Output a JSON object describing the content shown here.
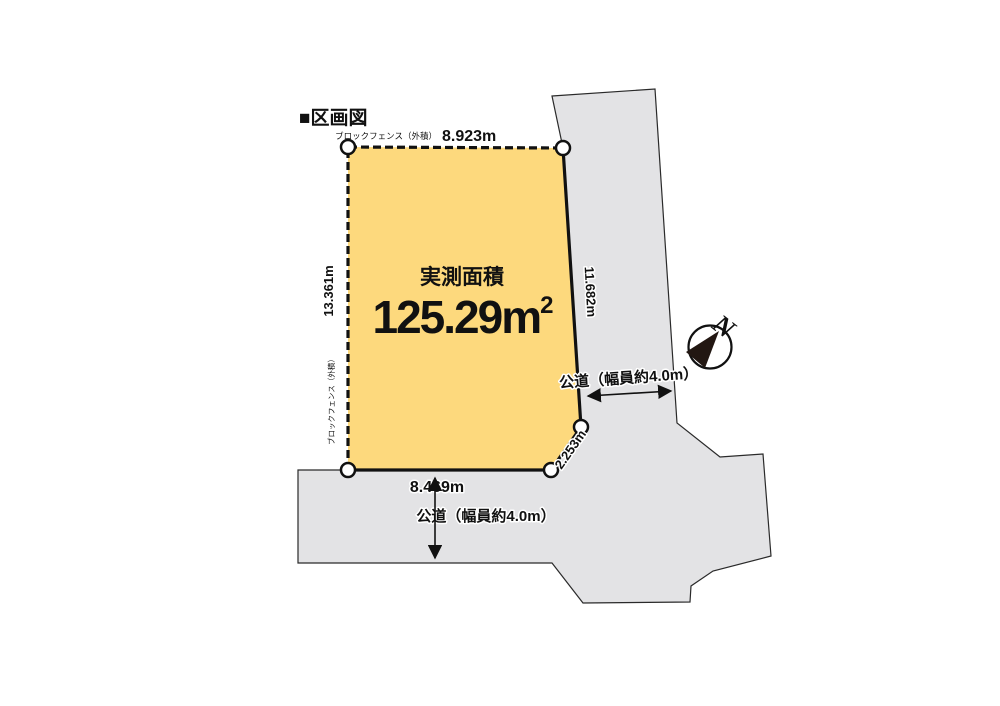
{
  "title": "■区画図",
  "colors": {
    "parcel_fill": "#FDD97D",
    "road_fill": "#E3E3E5",
    "line": "#111111",
    "needle_fill": "#221712"
  },
  "parcel": {
    "area_label": "実測面積",
    "area_value": "125.29",
    "area_unit": "m",
    "area_sup": "2",
    "edges": {
      "top": {
        "fence": "ブロックフェンス（外積）",
        "length": "8.923m"
      },
      "left": {
        "fence": "ブロックフェンス（外積）",
        "length": "13.361m"
      },
      "right": {
        "length": "11.682m"
      },
      "chamfer": {
        "length": "2.253m"
      },
      "bottom": {
        "length": "8.469m"
      }
    }
  },
  "roads": {
    "east": {
      "label": "公道（幅員約4.0m）"
    },
    "south": {
      "label": "公道（幅員約4.0m）"
    }
  },
  "compass": {
    "label": "N"
  }
}
